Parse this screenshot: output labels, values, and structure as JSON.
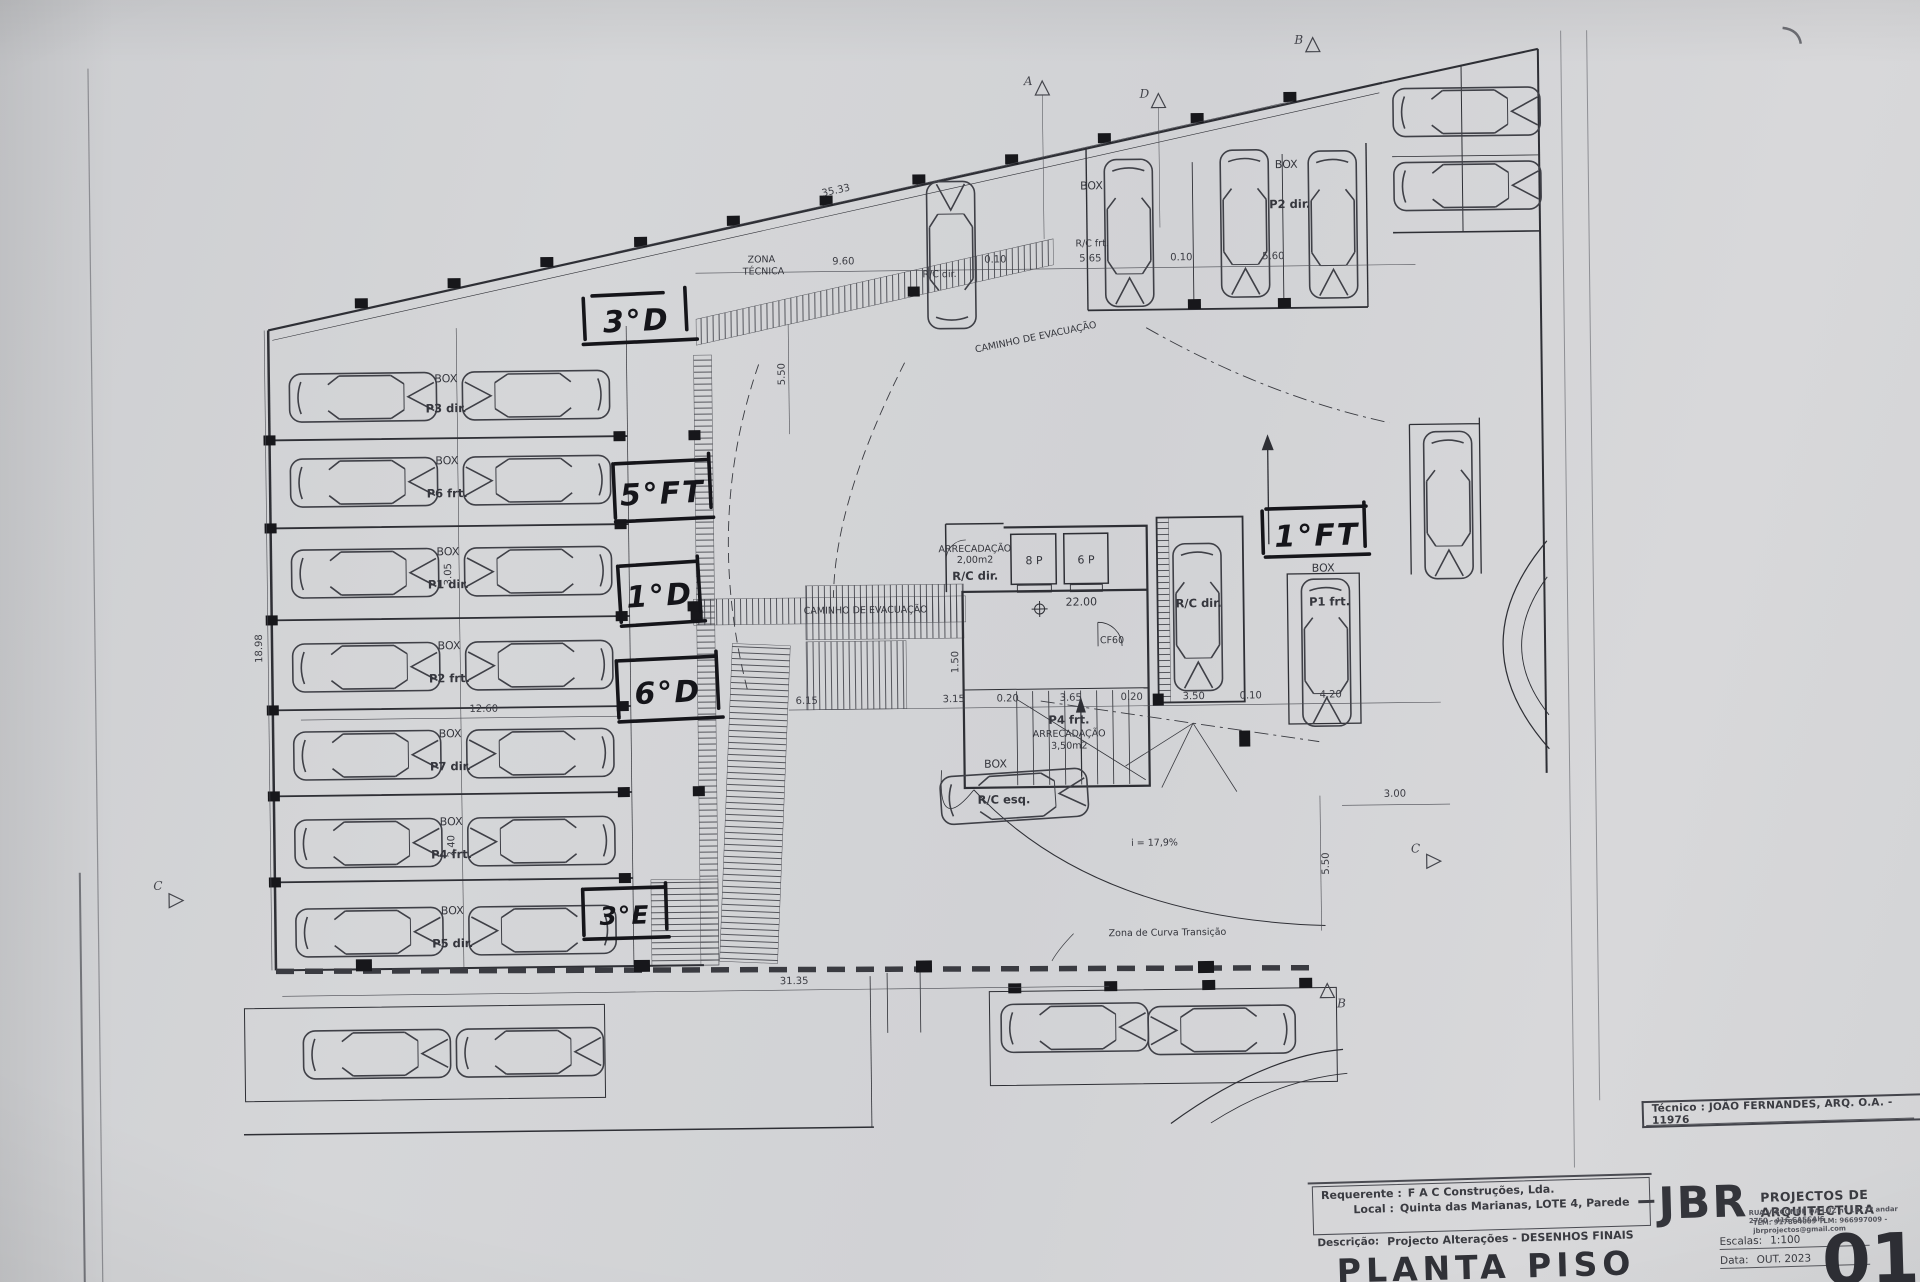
{
  "colors": {
    "paper": "#d3d4d6",
    "ink": "#2e2f35",
    "ink_dark": "#17171c"
  },
  "plan": {
    "box": "BOX",
    "zona1": "ZONA",
    "zona2": "TÉCNICA",
    "caminho": "CAMINHO  DE  EVACUAÇÃO",
    "curva": "Zona de Curva Transição",
    "slope": "i = 17,9%",
    "level": "22.00",
    "cf60": "CF60",
    "lift1": "8 P",
    "lift2": "6 P",
    "arrec_small_1": "ARRECADAÇÃO",
    "arrec_small_2": "2,00m2",
    "arrec_big_1": "ARRECADAÇÃO",
    "arrec_big_2": "3,50m2",
    "rc_dir": "R/C dir.",
    "rc_esq": "R/C esq.",
    "rc_frt": "R/C frt.",
    "p4": "P4 frt.",
    "p2": "P2 dir.",
    "p1": "P1 frt.",
    "stall_r1": "P3 dir.",
    "stall_r2": "P6 frt.",
    "stall_r3": "P1 dir.",
    "stall_r4": "P2 frt.",
    "stall_r5": "P7 dir.",
    "stall_r6": "P4 frt.",
    "stall_r7": "P5 dir.",
    "hand_3d": "3°D",
    "hand_5ft": "5°FT",
    "hand_1d": "1°D",
    "hand_6d": "6°D",
    "hand_3e": "3°E",
    "hand_1ft": "1°FT",
    "mk_a": "A",
    "mk_d": "D",
    "mk_b": "B",
    "mk_c": "C",
    "dim_top_total": "35.33",
    "dim_bottom_total": "31.35",
    "dim_960": "9.60",
    "dim_010": "0.10",
    "dim_565": "5.65",
    "dim_560": "5.60",
    "dim_1898": "18.98",
    "dim_550": "5.50",
    "dim_305": "3.05",
    "dim_240": "2.40",
    "dim_1260": "12.60",
    "dim_615": "6.15",
    "dim_315": "3.15",
    "dim_020": "0.20",
    "dim_365": "3.65",
    "dim_350": "3.50",
    "dim_420": "4.20",
    "dim_300": "3.00",
    "dim_150": "1.50"
  },
  "titleblock": {
    "tecnico": "Técnico : JOÃO FERNANDES, ARQ.   O.A. - 11976",
    "jbr": "JBR",
    "firm": "PROJECTOS DE ARQUITECTURA",
    "addr1": "RUA VISCONDE DA LUZ nº 1B, 1º andar  2750 - 416  CASCAIS",
    "addr2": "TLM: 917804009  TLM: 966997009 - jbrprojectos@gmail.com",
    "req_label": "Requerente :",
    "req": "F A C  Construções, Lda.",
    "local_label": "Local :",
    "local": "Quinta das Marianas, LOTE 4, Parede",
    "desc_label": "Descrição:",
    "desc": "Projecto Alterações - DESENHOS FINAIS",
    "title": "PLANTA PISO -2",
    "escala_label": "Escalas:",
    "escala": "1:100",
    "data_label": "Data:",
    "data": "OUT. 2023",
    "num": "01"
  }
}
